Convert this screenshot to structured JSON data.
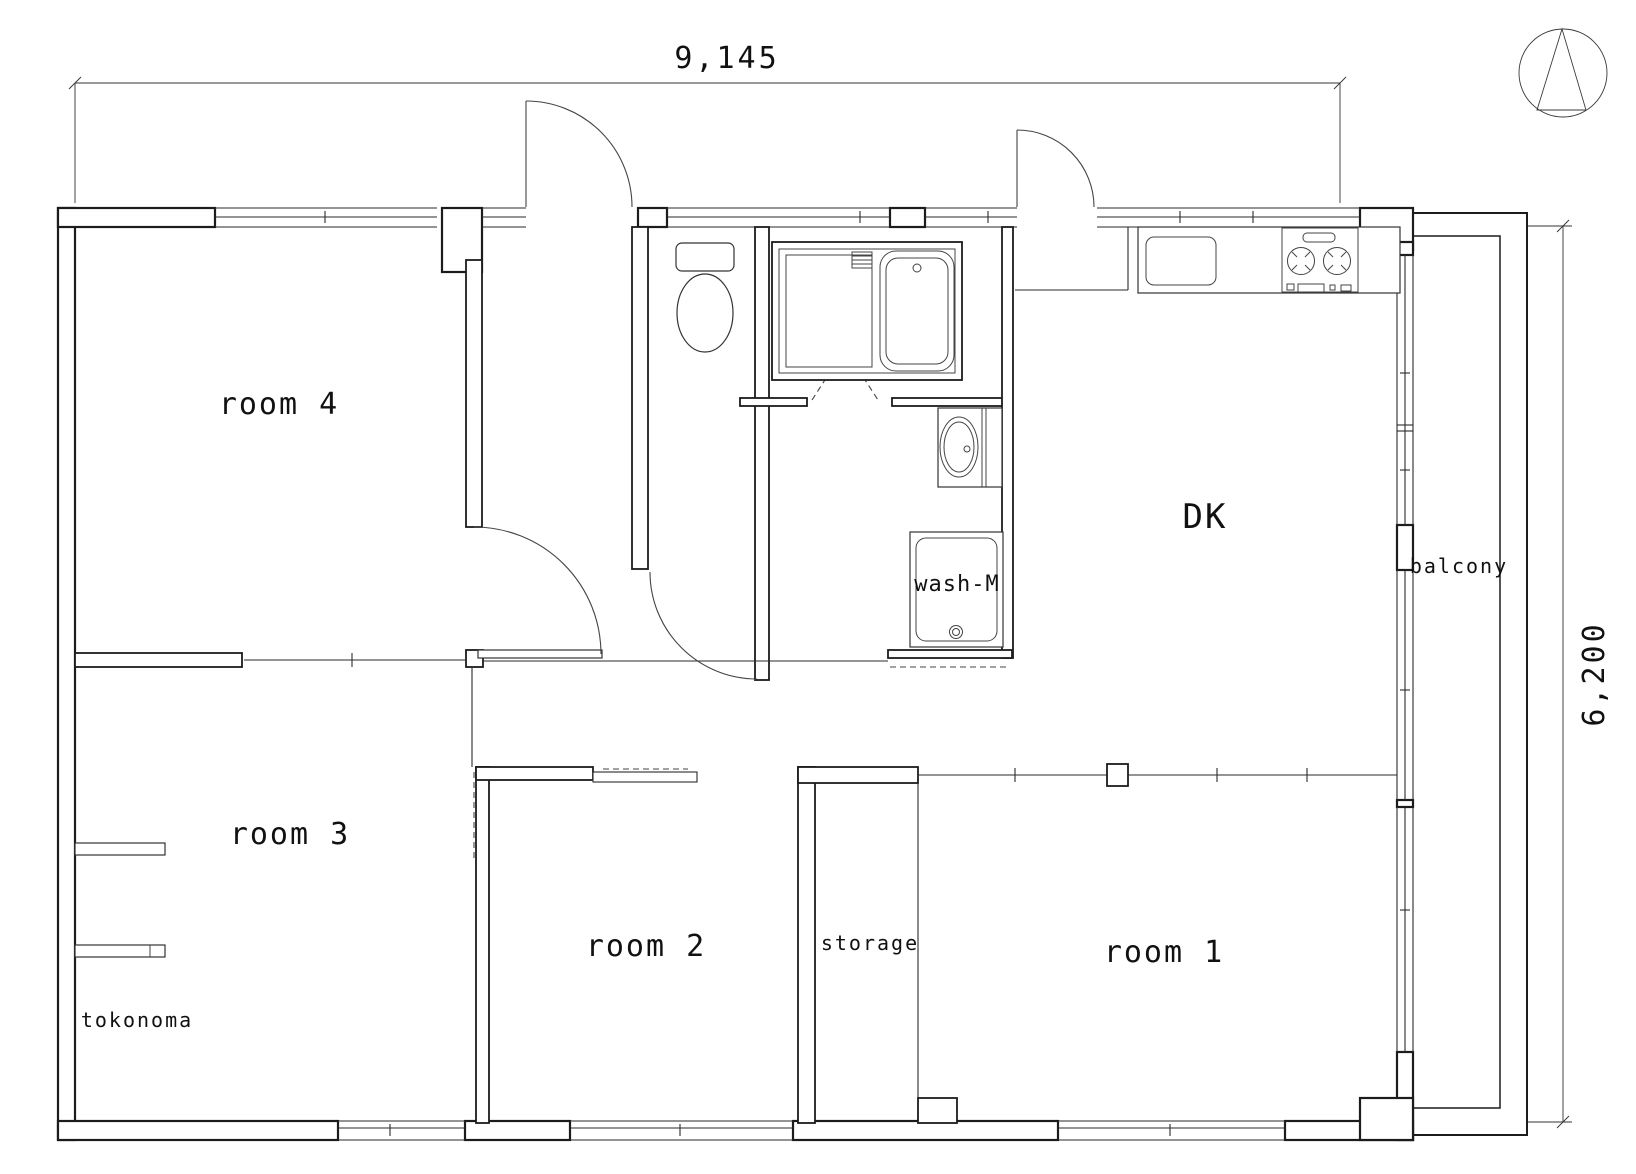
{
  "drawing": {
    "type": "apartment-floor-plan",
    "colors": {
      "line": "#1c1c1c",
      "background": "#ffffff"
    },
    "rooms": {
      "room1": "room 1",
      "room2": "room 2",
      "room3": "room 3",
      "room4": "room 4",
      "dk": "DK",
      "balcony": "balcony",
      "storage": "storage",
      "tokonoma": "tokonoma",
      "washing_machine": "wash-M"
    },
    "dimensions": {
      "overall_width": "9,145",
      "overall_height": "6,200"
    },
    "icons": {
      "north_arrow": "compass-triangle-in-circle"
    }
  }
}
